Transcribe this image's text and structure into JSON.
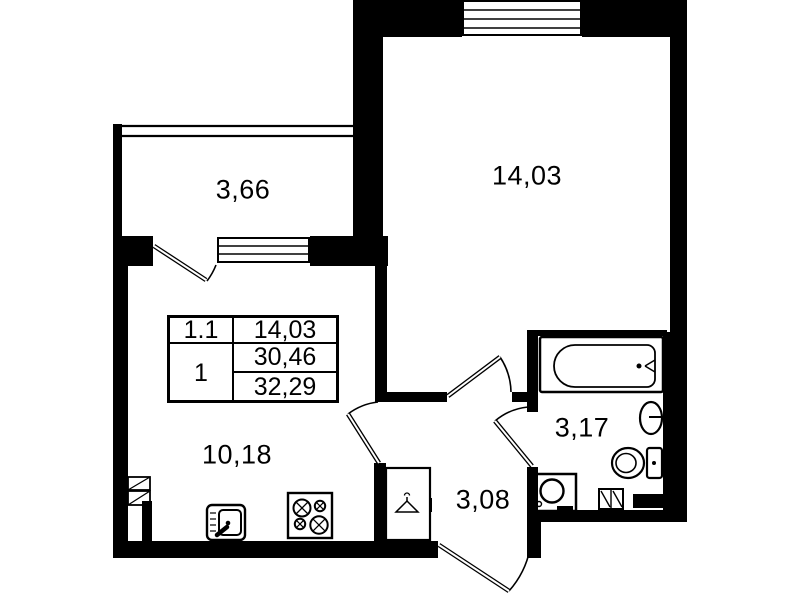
{
  "document": {
    "type": "apartment floor plan"
  },
  "room_labels": {
    "balcony": "3,66",
    "living_room": "14,03",
    "kitchen_living_room": "10,18",
    "hallway": "3,08",
    "bathroom": "3,17"
  },
  "legend_table": {
    "rows": [
      {
        "left": "1.1",
        "right": [
          "14,03"
        ]
      },
      {
        "left": "1",
        "right": [
          "30,46",
          "32,29"
        ]
      }
    ]
  },
  "fixtures": [
    "bathtub",
    "washbasin",
    "toilet",
    "washing-machine",
    "stove",
    "kitchen-sink",
    "wardrobe-hanger",
    "vent-shaft",
    "window",
    "door-swing"
  ],
  "colors": {
    "wall": "#000000",
    "background": "#ffffff",
    "line": "#000000"
  }
}
